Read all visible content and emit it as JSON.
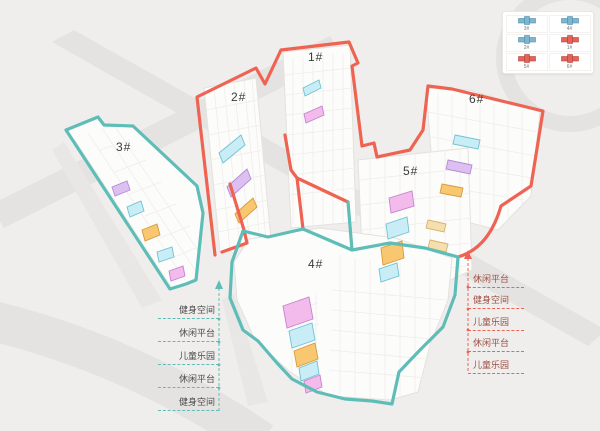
{
  "scene_title": "residential-site-axonometric-plan",
  "buildings": [
    {
      "label": "1#"
    },
    {
      "label": "2#"
    },
    {
      "label": "3#"
    },
    {
      "label": "4#"
    },
    {
      "label": "5#"
    },
    {
      "label": "6#"
    }
  ],
  "left_panel": {
    "labels": [
      "健身空间",
      "休闲平台",
      "儿童乐园",
      "休闲平台",
      "健身空间"
    ]
  },
  "right_panel": {
    "labels": [
      "休闲平台",
      "健身空间",
      "儿童乐园",
      "休闲平台",
      "儿童乐园"
    ]
  },
  "legend": {
    "items": [
      {
        "label": "3#",
        "type": "blue"
      },
      {
        "label": "4#",
        "type": "blue"
      },
      {
        "label": "2#",
        "type": "blue"
      },
      {
        "label": "1#",
        "type": "red"
      },
      {
        "label": "5#",
        "type": "red"
      },
      {
        "label": "6#",
        "type": "red"
      }
    ]
  },
  "colors": {
    "red": "#ee6352",
    "teal": "#5fbdb8",
    "cyan": "#c9edf6",
    "cyan_b": "#6fc3cf",
    "pink": "#f2bbec",
    "pink_b": "#c583cf",
    "purple": "#dcc0f2",
    "purple_b": "#b48ad6",
    "orange": "#f8c76f",
    "orange_b": "#d79a3e",
    "tan": "#f5dfae",
    "tan_b": "#d8b26a",
    "legend_blue": "#7fb5cd",
    "legend_red": "#e2645a"
  }
}
